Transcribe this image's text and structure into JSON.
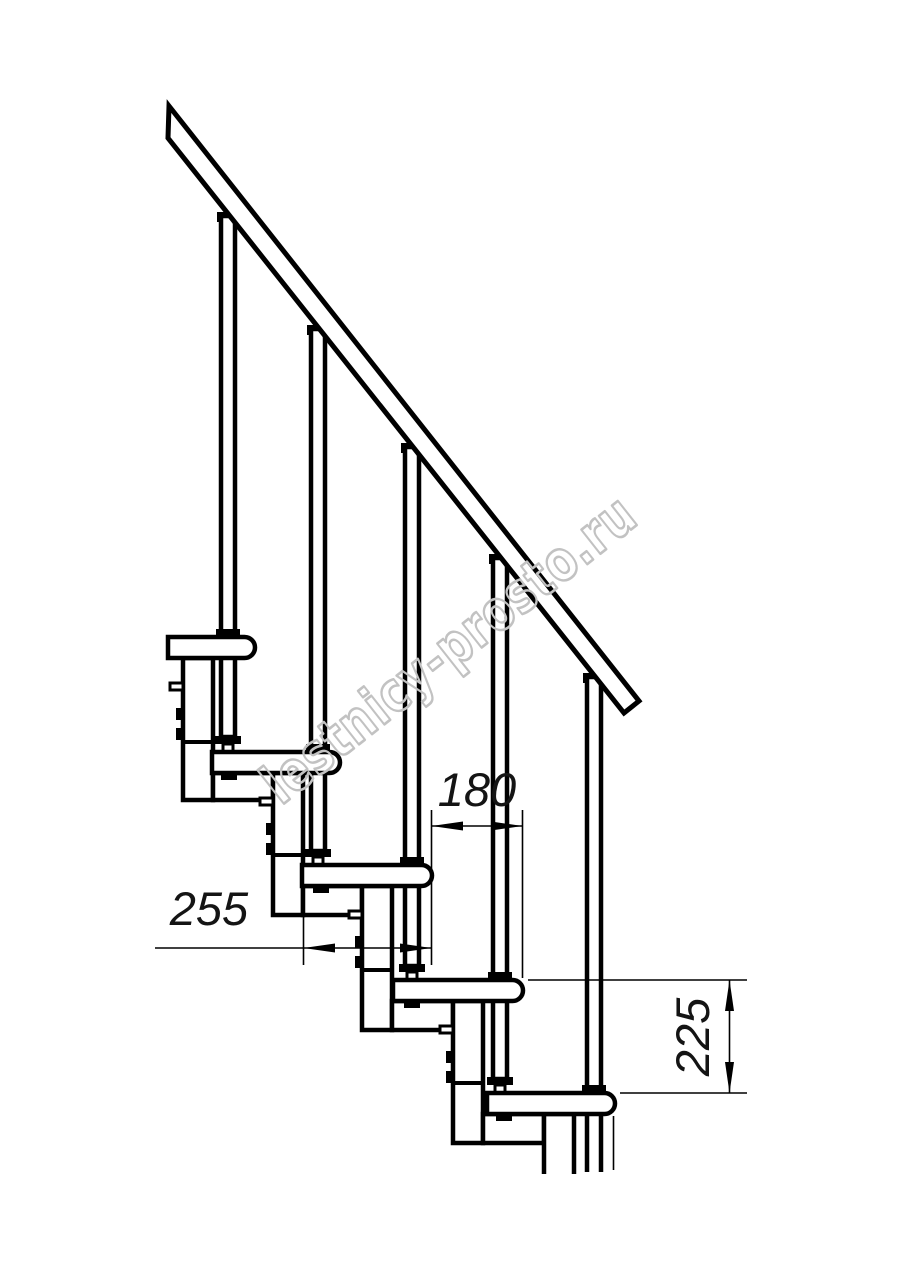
{
  "drawing": {
    "title": "staircase-side-elevation",
    "line_color": "#000000",
    "background_color": "#ffffff"
  },
  "dimensions": {
    "step_run": {
      "label": "180",
      "orientation": "horizontal"
    },
    "tread_depth": {
      "label": "255",
      "orientation": "horizontal"
    },
    "step_rise": {
      "label": "225",
      "orientation": "vertical"
    }
  },
  "watermark": {
    "text": "lestnicy-prosto.ru",
    "color": "#c2c2c2"
  }
}
